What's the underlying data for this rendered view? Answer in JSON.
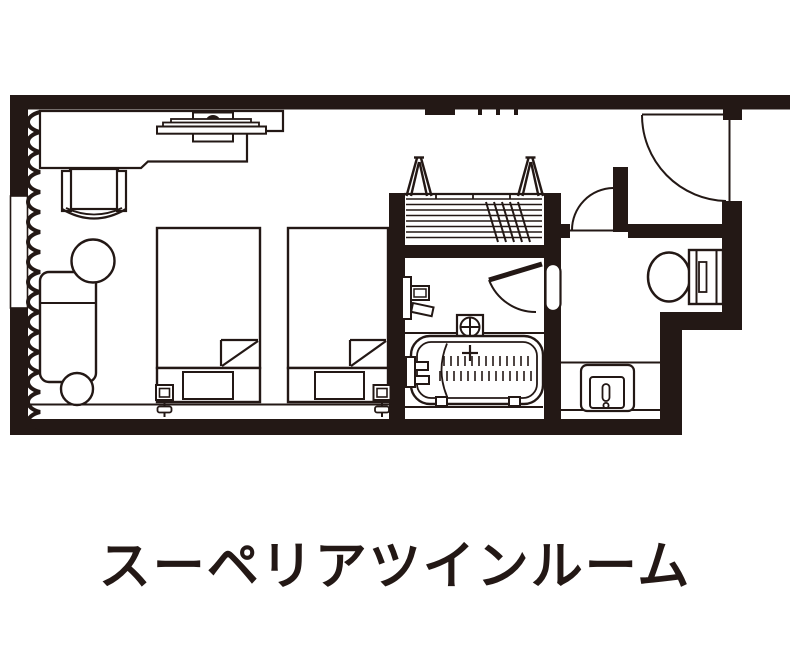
{
  "title": "スーペリアツインルーム",
  "colors": {
    "ink": "#231815",
    "background": "#ffffff"
  },
  "fixtures": [
    "window",
    "curtain-line",
    "desk",
    "flat-tv",
    "desk-chair",
    "round-table",
    "sofa",
    "ottoman",
    "twin-bed-left",
    "twin-bed-right",
    "reading-lamp-left",
    "reading-lamp-right",
    "closet-shelves",
    "clothes-hanger",
    "entrance-door",
    "hall-door",
    "bathroom-door",
    "wash-basin",
    "shower-mixer",
    "bathtub",
    "grab-bar",
    "toilet",
    "vanity-sink"
  ]
}
